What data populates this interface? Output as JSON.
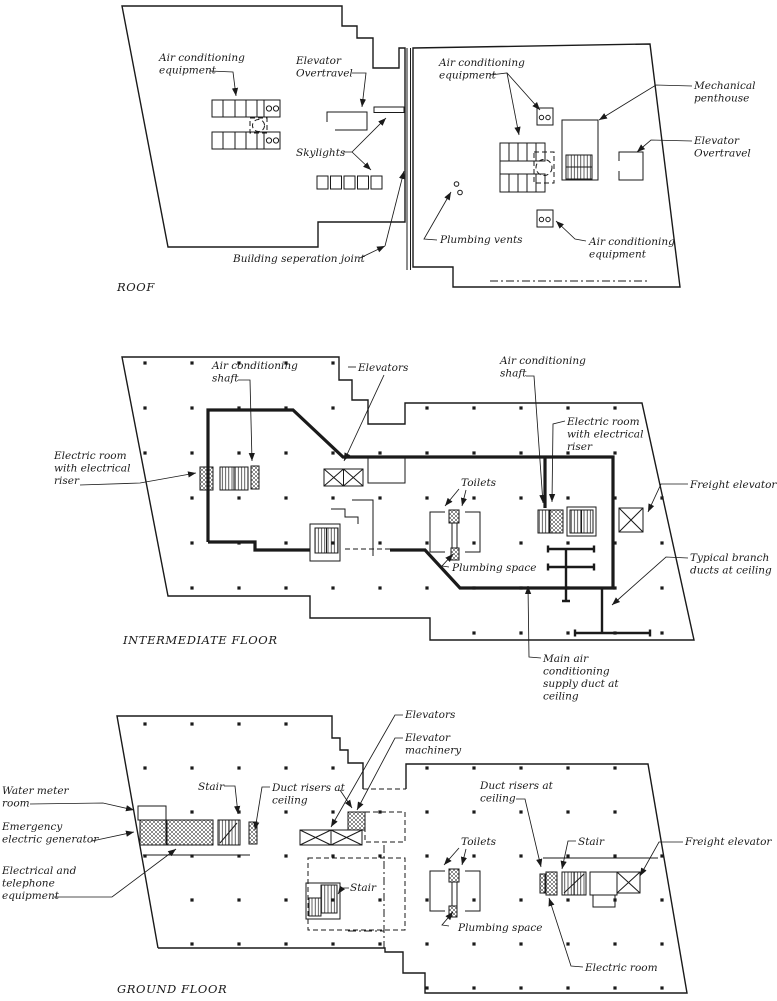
{
  "roof": {
    "caption": "ROOF",
    "labels": {
      "ac_equipment_left": [
        "Air conditioning",
        "equipment"
      ],
      "elevator_overtravel_left": [
        "Elevator",
        "Overtravel"
      ],
      "skylights": [
        "Skylights"
      ],
      "building_separation_joint": [
        "Building seperation joint"
      ],
      "ac_equipment_right_top": [
        "Air conditioning",
        "equipment"
      ],
      "mechanical_penthouse": [
        "Mechanical",
        "penthouse"
      ],
      "elevator_overtravel_right": [
        "Elevator",
        "Overtravel"
      ],
      "plumbing_vents": [
        "Plumbing vents"
      ],
      "ac_equipment_right_bottom": [
        "Air conditioning",
        "equipment"
      ]
    }
  },
  "intermediate": {
    "caption": "INTERMEDIATE FLOOR",
    "labels": {
      "ac_shaft_left": [
        "Air conditioning",
        "shaft"
      ],
      "elevators": [
        "Elevators"
      ],
      "ac_shaft_right": [
        "Air conditioning",
        "shaft"
      ],
      "electric_room_left": [
        "Electric room",
        "with electrical",
        "riser"
      ],
      "electric_room_right": [
        "Electric room",
        "with electrical",
        "riser"
      ],
      "toilets": [
        "Toilets"
      ],
      "plumbing_space": [
        "Plumbing space"
      ],
      "freight_elevator": [
        "Freight elevator"
      ],
      "typical_branch_ducts": [
        "Typical branch",
        "ducts at ceiling"
      ],
      "main_supply_duct": [
        "Main air",
        "conditioning",
        "supply duct at",
        "ceiling"
      ]
    }
  },
  "ground": {
    "caption": "GROUND FLOOR",
    "labels": {
      "water_meter_room": [
        "Water meter",
        "room"
      ],
      "emergency_generator": [
        "Emergency",
        "electric generator"
      ],
      "electrical_telephone": [
        "Electrical and",
        "telephone",
        "equipment"
      ],
      "stair_left": [
        "Stair"
      ],
      "duct_risers_left": [
        "Duct risers at",
        "ceiling"
      ],
      "elevators": [
        "Elevators"
      ],
      "elevator_machinery": [
        "Elevator",
        "machinery"
      ],
      "stair_mid": [
        "Stair"
      ],
      "toilets": [
        "Toilets"
      ],
      "plumbing_space": [
        "Plumbing space"
      ],
      "duct_risers_right": [
        "Duct risers at",
        "ceiling"
      ],
      "stair_right": [
        "Stair"
      ],
      "freight_elevator": [
        "Freight elevator"
      ],
      "electric_room": [
        "Electric room"
      ]
    }
  },
  "colors": {
    "ink": "#1a1a1a",
    "paper": "#ffffff"
  }
}
